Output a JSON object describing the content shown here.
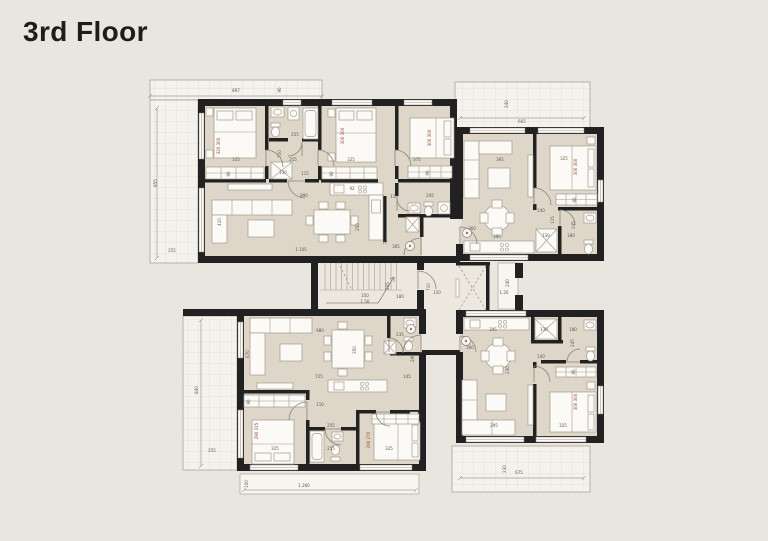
{
  "title": "3rd Floor",
  "colors": {
    "bg": "#e9e6e0",
    "wall": "#212121",
    "room": "#ded6c8",
    "core": "#ece8e0",
    "balc": "#f4f2ec",
    "grid": "#d9d4c9",
    "furn": "#fbfaf7",
    "fstroke": "#a39a8c",
    "line": "#8b8276",
    "dim": "#5e564b",
    "dimred": "#9c4036",
    "bedge": "#b3ac9e",
    "title": "#1d1d1b"
  },
  "dims": [
    [
      236,
      92,
      "897",
      0,
      0
    ],
    [
      281,
      90,
      "90",
      1,
      0
    ],
    [
      157,
      183,
      "855",
      1,
      0
    ],
    [
      172,
      252,
      "255",
      0,
      0
    ],
    [
      236,
      161,
      "325",
      0,
      0
    ],
    [
      220,
      146,
      "320 300",
      1,
      1
    ],
    [
      295,
      136,
      "255",
      0,
      0
    ],
    [
      281,
      154,
      "710",
      1,
      0
    ],
    [
      293,
      161,
      "255",
      0,
      0
    ],
    [
      283,
      174,
      "130",
      0,
      0
    ],
    [
      305,
      175,
      "115",
      0,
      0
    ],
    [
      230,
      174,
      "90",
      1,
      0
    ],
    [
      351,
      161,
      "325",
      0,
      0
    ],
    [
      344,
      136,
      "300 300",
      1,
      1
    ],
    [
      333,
      174,
      "90",
      1,
      0
    ],
    [
      417,
      161,
      "375",
      0,
      0
    ],
    [
      431,
      138,
      "300 300",
      1,
      1
    ],
    [
      429,
      173,
      "90",
      1,
      0
    ],
    [
      394,
      198,
      "110",
      0,
      0
    ],
    [
      430,
      197,
      "245",
      0,
      0
    ],
    [
      304,
      197,
      "890",
      0,
      0
    ],
    [
      359,
      227,
      "250",
      1,
      0
    ],
    [
      301,
      251,
      "1.105",
      0,
      0
    ],
    [
      221,
      222,
      "410",
      1,
      0
    ],
    [
      352,
      190,
      "92",
      0,
      0
    ],
    [
      396,
      248,
      "365",
      0,
      0
    ],
    [
      387,
      242,
      "75",
      1,
      0
    ],
    [
      522,
      123,
      "665",
      0,
      0
    ],
    [
      508,
      104,
      "240",
      1,
      0
    ],
    [
      500,
      161,
      "395",
      0,
      0
    ],
    [
      497,
      238,
      "395",
      0,
      0
    ],
    [
      564,
      160,
      "325",
      0,
      0
    ],
    [
      577,
      167,
      "300 300",
      1,
      1
    ],
    [
      576,
      200,
      "90",
      1,
      0
    ],
    [
      541,
      212,
      "140",
      0,
      0
    ],
    [
      554,
      220,
      "115",
      1,
      0
    ],
    [
      546,
      237,
      "130",
      0,
      0
    ],
    [
      571,
      237,
      "180",
      0,
      0
    ],
    [
      575,
      225,
      "245",
      1,
      0
    ],
    [
      472,
      230,
      "360",
      0,
      0
    ],
    [
      365,
      297,
      "350",
      0,
      0
    ],
    [
      365,
      303,
      "1.50",
      0,
      0
    ],
    [
      400,
      298,
      "180",
      0,
      0
    ],
    [
      389,
      286,
      "205",
      1,
      0
    ],
    [
      437,
      294,
      "150",
      0,
      0
    ],
    [
      430,
      287,
      "710",
      1,
      0
    ],
    [
      504,
      294,
      "1.20",
      0,
      0
    ],
    [
      509,
      283,
      "240",
      1,
      0
    ],
    [
      320,
      332,
      "980",
      0,
      0
    ],
    [
      249,
      354,
      "670",
      1,
      0
    ],
    [
      319,
      378,
      "725",
      0,
      0
    ],
    [
      356,
      350,
      "350",
      1,
      0
    ],
    [
      400,
      336,
      "235",
      0,
      0
    ],
    [
      407,
      378,
      "145",
      0,
      0
    ],
    [
      414,
      358,
      "290",
      1,
      0
    ],
    [
      320,
      406,
      "110",
      0,
      0
    ],
    [
      331,
      427,
      "255",
      0,
      0
    ],
    [
      275,
      450,
      "325",
      0,
      0
    ],
    [
      258,
      431,
      "290 315",
      1,
      1
    ],
    [
      250,
      402,
      "90",
      1,
      0
    ],
    [
      331,
      450,
      "255",
      0,
      0
    ],
    [
      389,
      450,
      "325",
      0,
      0
    ],
    [
      370,
      440,
      "290 270",
      1,
      1
    ],
    [
      198,
      390,
      "840",
      1,
      0
    ],
    [
      212,
      452,
      "255",
      0,
      0
    ],
    [
      304,
      487,
      "1.260",
      0,
      0
    ],
    [
      248,
      484,
      "100",
      1,
      0
    ],
    [
      493,
      331,
      "395",
      0,
      0
    ],
    [
      544,
      331,
      "130",
      0,
      0
    ],
    [
      573,
      331,
      "180",
      0,
      0
    ],
    [
      574,
      343,
      "245",
      1,
      0
    ],
    [
      470,
      349,
      "360",
      0,
      0
    ],
    [
      509,
      370,
      "230",
      1,
      0
    ],
    [
      494,
      427,
      "295",
      0,
      0
    ],
    [
      563,
      427,
      "325",
      0,
      0
    ],
    [
      577,
      402,
      "300 300",
      1,
      1
    ],
    [
      575,
      372,
      "90",
      1,
      0
    ],
    [
      541,
      358,
      "140",
      0,
      0
    ],
    [
      519,
      474,
      "675",
      0,
      0
    ],
    [
      506,
      469,
      "230",
      1,
      0
    ]
  ]
}
